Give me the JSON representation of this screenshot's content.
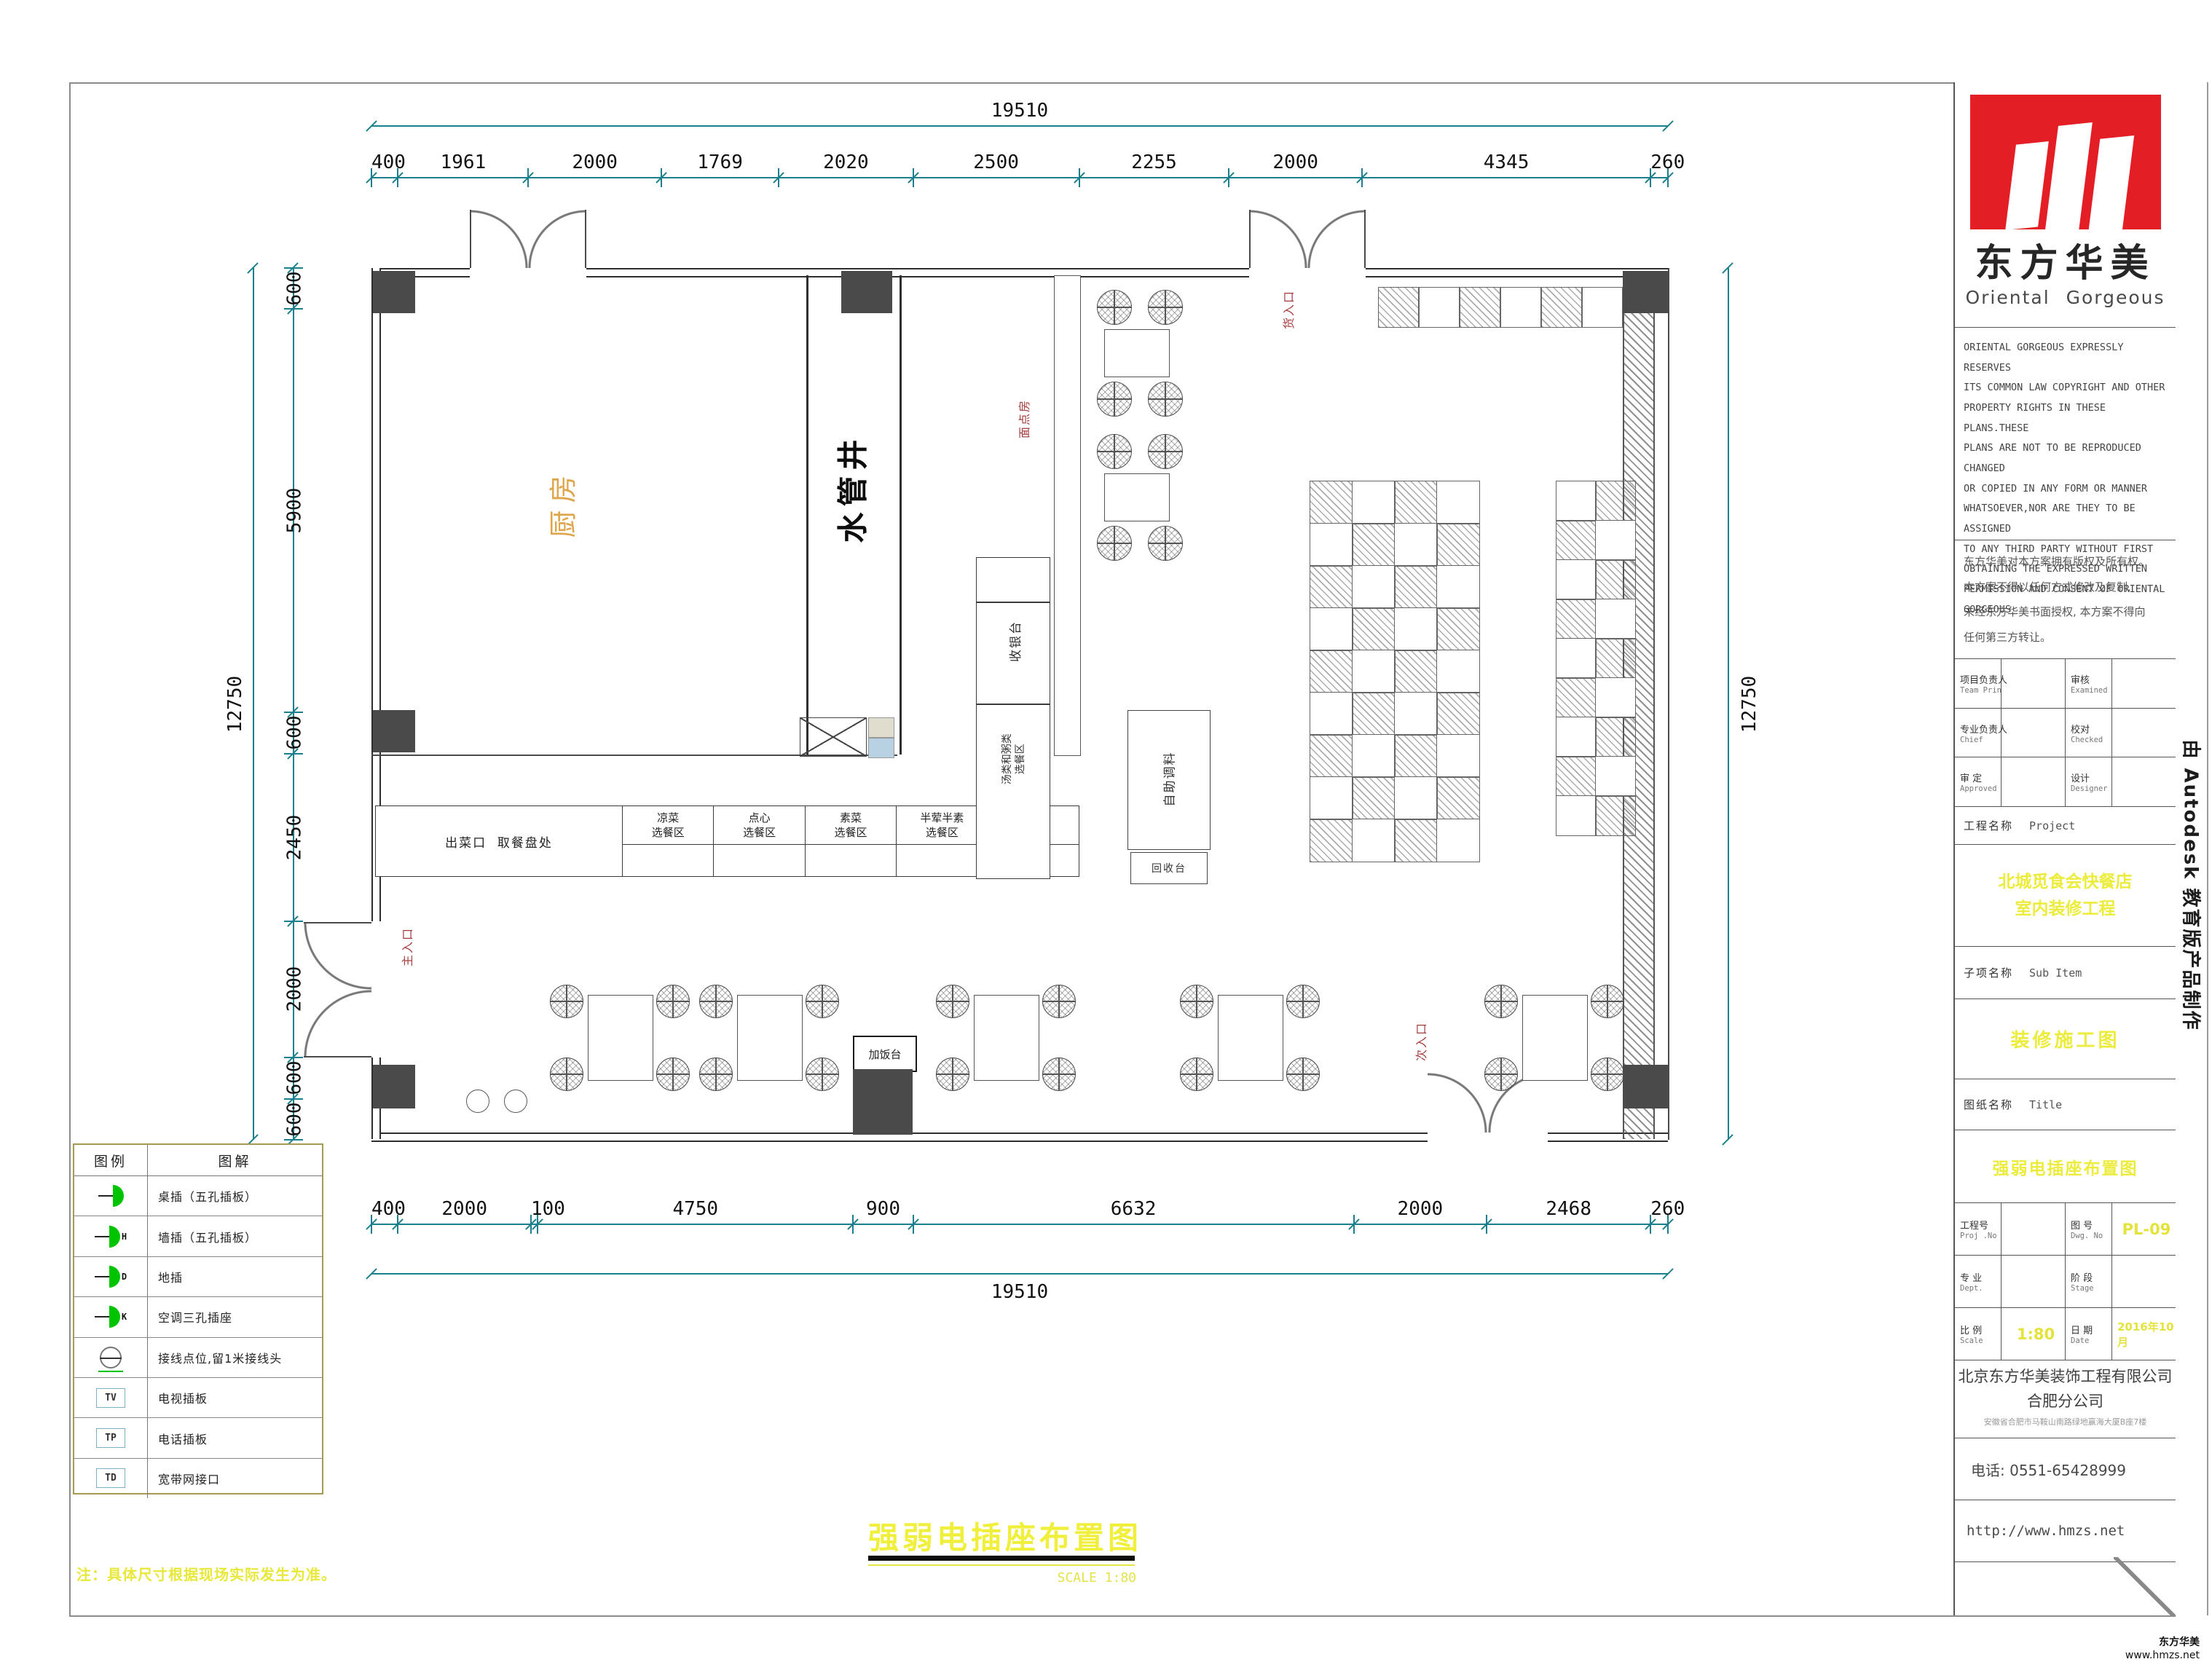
{
  "drawing": {
    "title": "强弱电插座布置图",
    "title_scale": "SCALE  1:80",
    "note": "注：具体尺寸根据现场实际发生为准。",
    "rooms": {
      "kitchen": "厨房",
      "water_shaft": "水管井",
      "pastry_room": "面点房",
      "cashier": "收银台",
      "soup_line1": "汤类和粥类",
      "soup_line2": "选餐区",
      "self_service": "自助调料",
      "return_counter": "回收台",
      "rice_counter": "加饭台",
      "main_entrance": "主入口",
      "goods_entrance": "货入口",
      "secondary_entrance": "次入口",
      "serving_exit": "出菜口  取餐盘处",
      "counters": [
        {
          "l1": "凉菜",
          "l2": "选餐区"
        },
        {
          "l1": "点心",
          "l2": "选餐区"
        },
        {
          "l1": "素菜",
          "l2": "选餐区"
        },
        {
          "l1": "半荤半素",
          "l2": "选餐区"
        },
        {
          "l1": "荤菜",
          "l2": "选餐区"
        }
      ]
    },
    "dimensions": {
      "top_total": "19510",
      "top_segments": [
        "400",
        "1961",
        "2000",
        "1769",
        "2020",
        "2500",
        "2255",
        "2000",
        "4345",
        "260"
      ],
      "bottom_total": "19510",
      "bottom_segments": [
        "400",
        "2000",
        "100",
        "4750",
        "900",
        "6632",
        "2000",
        "2468",
        "260"
      ],
      "left_total": "12750",
      "left_segments": [
        "600",
        "5900",
        "600",
        "2450",
        "2000",
        "600",
        "600"
      ],
      "right_total": "12750"
    }
  },
  "legend": {
    "header_symbol": "图例",
    "header_desc": "图解",
    "rows": [
      {
        "icon": "plug-socket-icon",
        "tag": "",
        "desc": "桌插（五孔插板）"
      },
      {
        "icon": "plug-socket-icon",
        "tag": "H",
        "desc": "墙插（五孔插板）"
      },
      {
        "icon": "plug-socket-icon",
        "tag": "D",
        "desc": "地插"
      },
      {
        "icon": "plug-socket-icon",
        "tag": "K",
        "desc": "空调三孔插座"
      },
      {
        "icon": "junction-point-icon",
        "tag": "",
        "desc": "接线点位,留1米接线头"
      },
      {
        "icon": "tv-outlet-icon",
        "tag": "TV",
        "desc": "电视插板"
      },
      {
        "icon": "phone-outlet-icon",
        "tag": "TP",
        "desc": "电话插板"
      },
      {
        "icon": "network-outlet-icon",
        "tag": "TD",
        "desc": "宽带网接口"
      }
    ]
  },
  "title_block": {
    "logo": {
      "brand_cn": "东方华美",
      "brand_en": "Oriental Gorgeous"
    },
    "copyright_en": "ORIENTAL GORGEOUS EXPRESSLY RESERVES\nITS COMMON LAW COPYRIGHT AND OTHER\nPROPERTY RIGHTS IN THESE PLANS.THESE\nPLANS ARE NOT TO BE REPRODUCED CHANGED\nOR COPIED IN ANY FORM OR MANNER\nWHATSOEVER,NOR ARE THEY TO BE ASSIGNED\nTO ANY THIRD PARTY WITHOUT FIRST\nOBTAINING THE EXPRESSED WRITTEN\nPERMISSION AND CONSENT OF ORIENTAL\nGORGEOUS",
    "copyright_cn": "东方华美对本方案拥有版权及所有权。\n本方案不得以任何方式修改及复制,\n未经东方华美书面授权, 本方案不得向\n任何第三方转让。",
    "fields": [
      {
        "label_cn": "项目负责人",
        "label_en": "Team Prin",
        "value": "",
        "label2_cn": "审核",
        "label2_en": "Examined",
        "value2": ""
      },
      {
        "label_cn": "专业负责人",
        "label_en": "Chief",
        "value": "",
        "label2_cn": "校对",
        "label2_en": "Checked",
        "value2": ""
      },
      {
        "label_cn": "审 定",
        "label_en": "Approved",
        "value": "",
        "label2_cn": "设计",
        "label2_en": "Designer",
        "value2": ""
      }
    ],
    "project_label_cn": "工程名称",
    "project_label_en": "Project",
    "project_name": "北城觅食会快餐店\n室内装修工程",
    "subitem_label_cn": "子项名称",
    "subitem_label_en": "Sub Item",
    "subitem_name": "装修施工图",
    "sheet_label_cn": "图纸名称",
    "sheet_label_en": "Title",
    "sheet_name": "强弱电插座布置图",
    "grid": [
      {
        "label_cn": "工程号",
        "label_en": "Proj .No",
        "value": "",
        "label2_cn": "图 号",
        "label2_en": "Dwg. No",
        "value2": "PL-09"
      },
      {
        "label_cn": "专 业",
        "label_en": "Dept.",
        "value": "",
        "label2_cn": "阶 段",
        "label2_en": "Stage",
        "value2": ""
      },
      {
        "label_cn": "比 例",
        "label_en": "Scale",
        "value": "1:80",
        "label2_cn": "日 期",
        "label2_en": "Date",
        "value2": "2016年10月"
      }
    ],
    "company_line1": "北京东方华美装饰工程有限公司",
    "company_line2": "合肥分公司",
    "company_address": "安徽省合肥市马鞍山南路绿地赢海大厦B座7楼",
    "phone": "电话: 0551-65428999",
    "website": "http://www.hmzs.net",
    "colors": {
      "accent_red": "#e31e24",
      "highlight_yellow": "#ecec3a",
      "dimension_teal": "#1c7f8e",
      "socket_green": "#00c400"
    }
  },
  "watermark": "由 Autodesk 教育版产品制作",
  "footer": {
    "brand": "东方华美",
    "site": "www.hmzs.net"
  }
}
